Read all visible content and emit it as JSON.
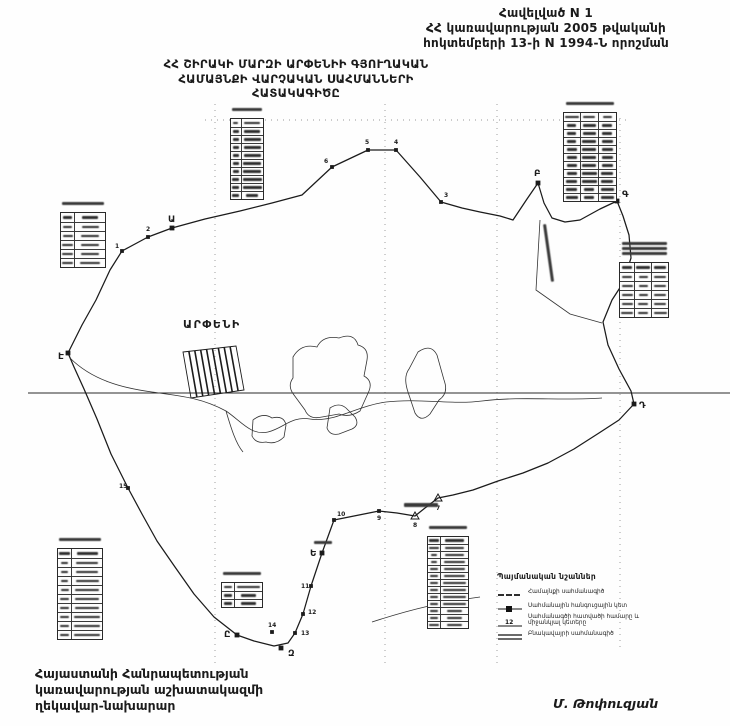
{
  "header_right": {
    "line1": "Հավելված  N 1",
    "line2": "ՀՀ կառավարության 2005 թվականի",
    "line3": "հոկտեմբերի 13-ի N 1994-Ն որոշման"
  },
  "map_title": {
    "line1": "ՀՀ ՇԻՐԱԿԻ ՄԱՐԶԻ ԱՐՓԵՆԻԻ ԳՅՈՒՂԱԿԱՆ",
    "line2": "ՀԱՄԱՅՆՔԻ ՎԱՐՉԱԿԱՆ ՍԱՀՄԱՆՆԵՐԻ",
    "line3": "ՀԱՏԱԿԱԳԻԾԸ"
  },
  "settlement_label": "ԱՐՓԵՆԻ",
  "legend": {
    "title": "Պայմանական նշաններ",
    "items": [
      {
        "symbol": "community-boundary-line",
        "label": "Համայնքի սահմանագիծ"
      },
      {
        "symbol": "boundary-node-point",
        "label": "Սահմանային հանգուցային կետ"
      },
      {
        "symbol": "segment-number",
        "example": "12",
        "label": "Սահմանագծի հատվածի համարը և միջանկյալ կետերը"
      },
      {
        "symbol": "settlement-boundary-line",
        "label": "Բնակավայրի սահմանագիծ"
      }
    ]
  },
  "signature": {
    "line1": "Հայաստանի Հանրապետության",
    "line2": "կառավարության աշխատակազմի",
    "line3": "ղեկավար-նախարար",
    "name": "Մ. Թոփուզյան"
  },
  "map_data": {
    "ink": "#1b1b1b",
    "boundary": [
      [
        68,
        353
      ],
      [
        82,
        325
      ],
      [
        96,
        300
      ],
      [
        110,
        270
      ],
      [
        122,
        251
      ],
      [
        148,
        237
      ],
      [
        172,
        228
      ],
      [
        205,
        219
      ],
      [
        240,
        211
      ],
      [
        272,
        203
      ],
      [
        302,
        195
      ],
      [
        332,
        167
      ],
      [
        368,
        150
      ],
      [
        396,
        150
      ],
      [
        420,
        177
      ],
      [
        441,
        202
      ],
      [
        462,
        208
      ],
      [
        480,
        212
      ],
      [
        500,
        216
      ],
      [
        513,
        220
      ],
      [
        527,
        199
      ],
      [
        538,
        183
      ],
      [
        544,
        203
      ],
      [
        552,
        218
      ],
      [
        565,
        222
      ],
      [
        580,
        220
      ],
      [
        600,
        209
      ],
      [
        617,
        201
      ],
      [
        623,
        216
      ],
      [
        629,
        235
      ],
      [
        631,
        258
      ],
      [
        623,
        283
      ],
      [
        612,
        300
      ],
      [
        603,
        322
      ],
      [
        608,
        345
      ],
      [
        619,
        369
      ],
      [
        631,
        391
      ],
      [
        634,
        404
      ],
      [
        619,
        420
      ],
      [
        599,
        433
      ],
      [
        574,
        449
      ],
      [
        548,
        463
      ],
      [
        523,
        473
      ],
      [
        498,
        481
      ],
      [
        473,
        490
      ],
      [
        453,
        495
      ],
      [
        438,
        498
      ],
      [
        425,
        508
      ],
      [
        415,
        516
      ],
      [
        397,
        513
      ],
      [
        379,
        511
      ],
      [
        354,
        516
      ],
      [
        334,
        520
      ],
      [
        322,
        553
      ],
      [
        311,
        586
      ],
      [
        303,
        614
      ],
      [
        295,
        633
      ],
      [
        288,
        643
      ],
      [
        274,
        646
      ],
      [
        254,
        641
      ],
      [
        237,
        635
      ],
      [
        214,
        617
      ],
      [
        194,
        594
      ],
      [
        175,
        567
      ],
      [
        157,
        541
      ],
      [
        142,
        514
      ],
      [
        128,
        488
      ],
      [
        111,
        454
      ],
      [
        97,
        419
      ],
      [
        84,
        389
      ],
      [
        74,
        367
      ]
    ],
    "letter_nodes": [
      {
        "label": "Ա",
        "x": 172,
        "y": 228,
        "dx": -4,
        "dy": -6
      },
      {
        "label": "Բ",
        "x": 538,
        "y": 183,
        "dx": -4,
        "dy": -7
      },
      {
        "label": "Գ",
        "x": 617,
        "y": 201,
        "dx": 5,
        "dy": -4
      },
      {
        "label": "Դ",
        "x": 634,
        "y": 404,
        "dx": 5,
        "dy": 4
      },
      {
        "label": "Ե",
        "x": 322,
        "y": 553,
        "dx": -12,
        "dy": 3
      },
      {
        "label": "Զ",
        "x": 281,
        "y": 648,
        "dx": 7,
        "dy": 8
      },
      {
        "label": "Ը",
        "x": 237,
        "y": 635,
        "dx": -13,
        "dy": 2
      },
      {
        "label": "Է",
        "x": 68,
        "y": 353,
        "dx": -10,
        "dy": 6
      }
    ],
    "numbered_points": [
      {
        "n": "1",
        "x": 122,
        "y": 251,
        "dx": -7,
        "dy": -3
      },
      {
        "n": "2",
        "x": 148,
        "y": 237,
        "dx": -2,
        "dy": -6
      },
      {
        "n": "3",
        "x": 441,
        "y": 202,
        "dx": 3,
        "dy": -5
      },
      {
        "n": "4",
        "x": 396,
        "y": 150,
        "dx": -2,
        "dy": -6
      },
      {
        "n": "5",
        "x": 368,
        "y": 150,
        "dx": -3,
        "dy": -6
      },
      {
        "n": "6",
        "x": 332,
        "y": 167,
        "dx": -8,
        "dy": -4
      },
      {
        "n": "9",
        "x": 379,
        "y": 511,
        "dx": -2,
        "dy": 9
      },
      {
        "n": "10",
        "x": 334,
        "y": 520,
        "dx": 3,
        "dy": -4
      },
      {
        "n": "11",
        "x": 311,
        "y": 586,
        "dx": -10,
        "dy": 2
      },
      {
        "n": "12",
        "x": 303,
        "y": 614,
        "dx": 5,
        "dy": 0
      },
      {
        "n": "13",
        "x": 295,
        "y": 633,
        "dx": 6,
        "dy": 2
      },
      {
        "n": "14",
        "x": 272,
        "y": 632,
        "dx": -4,
        "dy": -5
      },
      {
        "n": "15",
        "x": 128,
        "y": 488,
        "dx": -9,
        "dy": 0
      }
    ],
    "triangle_points": [
      {
        "n": "7",
        "x": 438,
        "y": 498,
        "dx": -2,
        "dy": 12
      },
      {
        "n": "8",
        "x": 415,
        "y": 516,
        "dx": -2,
        "dy": 11
      }
    ],
    "grid_verticals": [
      {
        "x": 215,
        "y1": 104,
        "y2": 666
      },
      {
        "x": 385,
        "y1": 104,
        "y2": 666
      },
      {
        "x": 497,
        "y1": 104,
        "y2": 666
      },
      {
        "x": 620,
        "y1": 118,
        "y2": 648
      }
    ],
    "grid_horizontals": [
      {
        "y": 120,
        "x1": 205,
        "x2": 628
      }
    ],
    "section_line": {
      "y": 393,
      "x1": 28,
      "x2": 730
    },
    "hatch_block": {
      "top": [
        [
          183,
          352
        ],
        [
          236,
          346
        ]
      ],
      "bottom": [
        [
          191,
          398
        ],
        [
          244,
          390
        ]
      ],
      "n": 9
    },
    "settlement_paths": [
      "M293,357 q8,-14 24,-10 q6,-12 22,-9 q15,-6 19,7 q11,3 9,15 l-3,16 q9,5 5,15 l-9,20 q-11,7 -21,3 l-17,3 q-13,3 -17,-7 l-11,-15 q-7,-9 -1,-17 z",
      "M418,352 q13,-9 19,3 l7,25 q5,13 -5,20 l-9,14 q-9,9 -15,-1 l-7,-21 q-5,-15 1,-23 z",
      "M253,420 q10,-8 19,-2 q12,-3 14,7 l-2,12 q-8,8 -18,5 q-10,2 -14,-6 z",
      "M330,408 q9,-6 16,0 l9,9 q5,8 -3,12 l-13,5 q-9,2 -12,-6 z"
    ],
    "line_paths": [
      "M70,358 C92,380 122,388 152,392 C182,396 202,398 226,411 C241,421 251,436 268,432 C284,428 291,416 310,419 C334,423 356,406 386,402 C420,398 452,405 482,401 C522,396 562,401 602,398",
      "M226,411 C231,428 236,444 243,452",
      "M372,622 C412,609 442,602 480,597",
      "M540,220 L536,290 L570,314 L602,323"
    ],
    "smudges": [
      {
        "x": 546,
        "y": 224,
        "w": 58,
        "h": 3,
        "rot": 82
      },
      {
        "x": 404,
        "y": 503,
        "w": 34,
        "h": 4,
        "rot": 0
      },
      {
        "x": 314,
        "y": 541,
        "w": 18,
        "h": 3,
        "rot": 0
      }
    ],
    "tables": [
      {
        "x": 230,
        "y": 118,
        "w": 34,
        "rows": 10,
        "cols": 2,
        "rh": 8,
        "headerLines": 1
      },
      {
        "x": 60,
        "y": 212,
        "w": 46,
        "rows": 6,
        "cols": 2,
        "rh": 9,
        "headerLines": 1
      },
      {
        "x": 563,
        "y": 112,
        "w": 54,
        "rows": 11,
        "cols": 3,
        "rh": 8,
        "headerLines": 1
      },
      {
        "x": 619,
        "y": 262,
        "w": 50,
        "rows": 6,
        "cols": 3,
        "rh": 9,
        "headerLines": 3
      },
      {
        "x": 57,
        "y": 548,
        "w": 46,
        "rows": 10,
        "cols": 2,
        "rh": 9,
        "headerLines": 1
      },
      {
        "x": 221,
        "y": 582,
        "w": 42,
        "rows": 3,
        "cols": 2,
        "rh": 8,
        "headerLines": 1
      },
      {
        "x": 427,
        "y": 536,
        "w": 42,
        "rows": 13,
        "cols": 2,
        "rh": 7,
        "headerLines": 1
      }
    ]
  }
}
